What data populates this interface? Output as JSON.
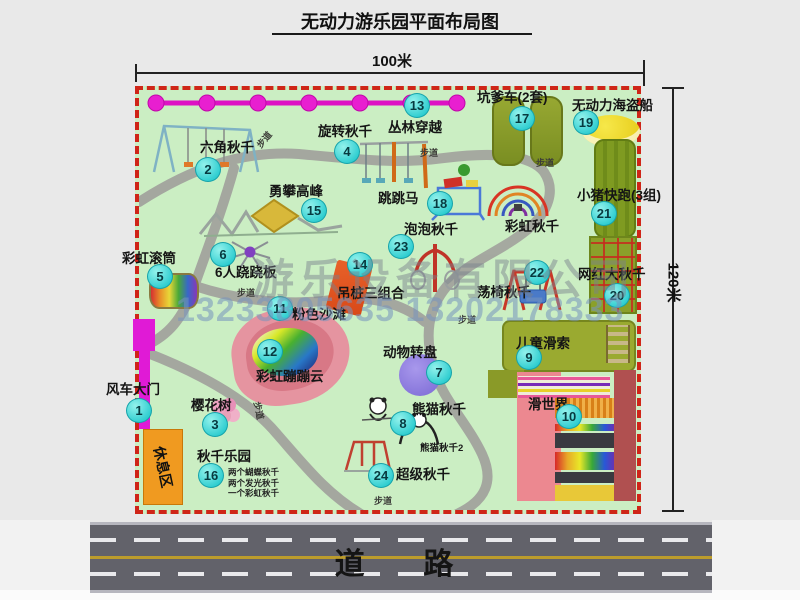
{
  "title": "无动力游乐园平面布局图",
  "dimensions": {
    "top": "100米",
    "right": "120米"
  },
  "watermark": {
    "company": "游乐设备有限公司",
    "phone": "13233805635 13202178333"
  },
  "road": {
    "label": "道  路"
  },
  "map": {
    "rest_area": "休息区",
    "walkway_text": "步道",
    "walkway_labels": [
      {
        "x": 255,
        "y": 133,
        "rot": -50
      },
      {
        "x": 420,
        "y": 146,
        "rot": 0
      },
      {
        "x": 536,
        "y": 156,
        "rot": 0
      },
      {
        "x": 237,
        "y": 286,
        "rot": 0
      },
      {
        "x": 458,
        "y": 313,
        "rot": 0
      },
      {
        "x": 250,
        "y": 404,
        "rot": 78
      },
      {
        "x": 374,
        "y": 494,
        "rot": 0
      }
    ],
    "attractions": [
      {
        "num": "1",
        "label": "风车大门",
        "bx": 126,
        "by": 398,
        "lx": 106,
        "ly": 378
      },
      {
        "num": "2",
        "label": "六角秋千",
        "bx": 195,
        "by": 157,
        "lx": 200,
        "ly": 136
      },
      {
        "num": "3",
        "label": "樱花树",
        "bx": 202,
        "by": 412,
        "lx": 191,
        "ly": 394
      },
      {
        "num": "4",
        "label": "旋转秋千",
        "bx": 334,
        "by": 139,
        "lx": 318,
        "ly": 120
      },
      {
        "num": "5",
        "label": "彩虹滚筒",
        "bx": 147,
        "by": 264,
        "lx": 122,
        "ly": 247
      },
      {
        "num": "6",
        "label": "6人跷跷板",
        "bx": 210,
        "by": 242,
        "lx": 215,
        "ly": 261
      },
      {
        "num": "7",
        "label": "动物转盘",
        "bx": 426,
        "by": 360,
        "lx": 383,
        "ly": 341
      },
      {
        "num": "8",
        "label": "熊猫秋千",
        "bx": 390,
        "by": 411,
        "lx": 412,
        "ly": 398,
        "sub": "熊猫秋千2",
        "sx": 420,
        "sy": 440
      },
      {
        "num": "9",
        "label": "儿童滑索",
        "bx": 516,
        "by": 345,
        "lx": 516,
        "ly": 332
      },
      {
        "num": "10",
        "label": "滑世界",
        "bx": 556,
        "by": 404,
        "lx": 528,
        "ly": 393
      },
      {
        "num": "11",
        "label": "粉色沙滩",
        "bx": 267,
        "by": 296,
        "lx": 292,
        "ly": 303
      },
      {
        "num": "12",
        "label": "彩虹蹦蹦云",
        "bx": 257,
        "by": 339,
        "lx": 256,
        "ly": 365
      },
      {
        "num": "13",
        "label": "丛林穿越",
        "bx": 404,
        "by": 93,
        "lx": 388,
        "ly": 116
      },
      {
        "num": "14",
        "label": "吊桩三组合",
        "bx": 347,
        "by": 252,
        "lx": 337,
        "ly": 282
      },
      {
        "num": "15",
        "label": "勇攀高峰",
        "bx": 301,
        "by": 198,
        "lx": 269,
        "ly": 180
      },
      {
        "num": "16",
        "label": "秋千乐园",
        "bx": 198,
        "by": 463,
        "lx": 197,
        "ly": 445,
        "notes": [
          "两个蝴蝶秋千",
          "两个发光秋千",
          "一个彩虹秋千"
        ],
        "nx": 228,
        "ny": 466
      },
      {
        "num": "17",
        "label": "坑爹车(2套)",
        "bx": 509,
        "by": 106,
        "lx": 477,
        "ly": 86
      },
      {
        "num": "18",
        "label": "跳跳马",
        "bx": 427,
        "by": 191,
        "lx": 378,
        "ly": 187
      },
      {
        "num": "19",
        "label": "无动力海盗船",
        "bx": 573,
        "by": 110,
        "lx": 572,
        "ly": 94
      },
      {
        "num": "20",
        "label": "网红大秋千",
        "bx": 604,
        "by": 283,
        "lx": 578,
        "ly": 263
      },
      {
        "num": "21",
        "label": "小猪快跑(3组)",
        "bx": 591,
        "by": 201,
        "lx": 577,
        "ly": 184
      },
      {
        "num": "22",
        "label": "荡椅秋千",
        "bx": 524,
        "by": 260,
        "lx": 477,
        "ly": 281
      },
      {
        "num": "23",
        "label": "泡泡秋千",
        "bx": 388,
        "by": 234,
        "lx": 404,
        "ly": 218
      },
      {
        "num": "24",
        "label": "超级秋千",
        "bx": 368,
        "by": 463,
        "lx": 396,
        "ly": 463
      },
      {
        "num": "",
        "label": "彩虹秋千",
        "lx": 505,
        "ly": 215
      }
    ]
  }
}
